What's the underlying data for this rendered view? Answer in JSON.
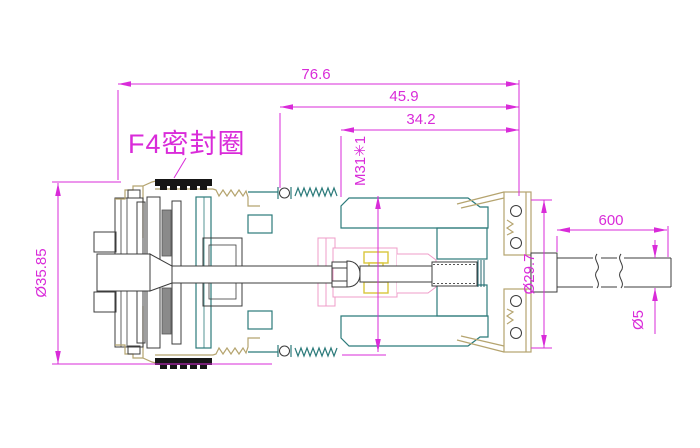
{
  "palette": {
    "dimension_magenta": "#d92bd9",
    "body_teal": "#2b7a7a",
    "fitting_tan": "#b5a46f",
    "insulator_pink": "#ef9cc8",
    "contact_yellow": "#d9c63c",
    "detail_gray": "#3c3c3c",
    "gasket_black": "#161616",
    "background": "#ffffff"
  },
  "annotations": {
    "seal_ring_label": "F4密封圈",
    "thread_spec": "M31✳1"
  },
  "dimensions": {
    "overall_length": "76.6",
    "body_length": "45.9",
    "thread_length": "34.2",
    "flange_diameter": "Ø35.85",
    "nut_diameter": "Ø29.7",
    "cable_length": "600",
    "cable_diameter": "Ø5"
  }
}
